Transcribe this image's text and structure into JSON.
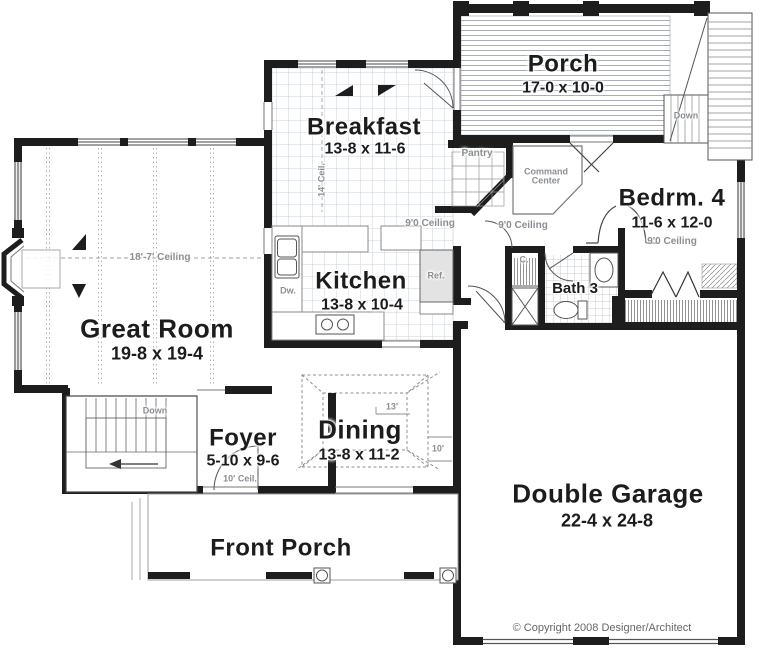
{
  "plan": {
    "rooms": {
      "porch": {
        "name": "Porch",
        "dims": "17-0 x 10-0"
      },
      "breakfast": {
        "name": "Breakfast",
        "dims": "13-8 x 11-6"
      },
      "bedroom4": {
        "name": "Bedrm. 4",
        "dims": "11-6 x 12-0"
      },
      "kitchen": {
        "name": "Kitchen",
        "dims": "13-8 x 10-4"
      },
      "great_room": {
        "name": "Great Room",
        "dims": "19-8 x 19-4"
      },
      "bath3": {
        "name": "Bath 3"
      },
      "foyer": {
        "name": "Foyer",
        "dims": "5-10 x 9-6"
      },
      "dining": {
        "name": "Dining",
        "dims": "13-8 x 11-2"
      },
      "garage": {
        "name": "Double Garage",
        "dims": "22-4 x 24-8"
      },
      "front_porch": {
        "name": "Front Porch"
      }
    },
    "annotations": {
      "ceiling_great_room": "18'-7' Ceiling",
      "ceiling_breakfast": "14' Ceil.",
      "ceiling_9": "9'0 Ceiling",
      "ceiling_foyer": "10' Ceil.",
      "tray_13": "13'",
      "tray_10": "10'",
      "pantry": "Pantry",
      "command_center": "Command Center",
      "refrigerator": "Ref.",
      "dishwasher": "Dw.",
      "closet": "C.",
      "down": "Down"
    },
    "footer": {
      "copyright": "© Copyright 2008 Designer/Architect"
    },
    "colors": {
      "wall": "#1d1d1d",
      "annotation": "#8a8f94",
      "tile_line": "#ccd3da",
      "deck_line": "#a8aeb6"
    }
  }
}
